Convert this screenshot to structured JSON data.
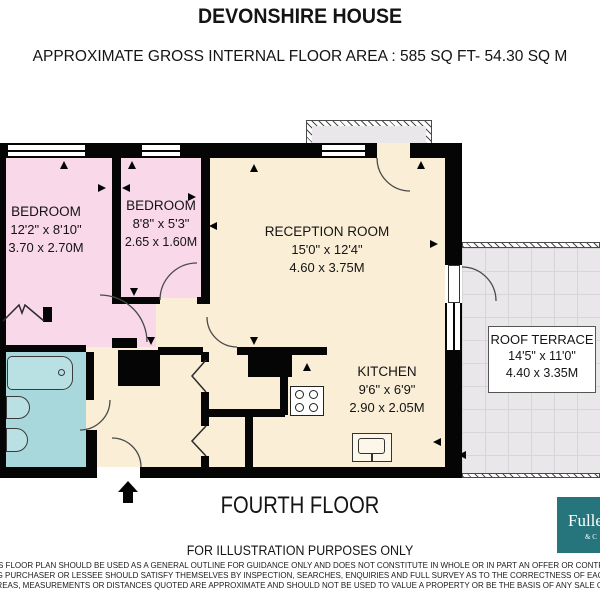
{
  "header": {
    "title": "DEVONSHIRE HOUSE",
    "subtitle": "APPROXIMATE GROSS INTERNAL FLOOR AREA :  585 SQ FT-  54.30 SQ M"
  },
  "rooms": {
    "bedroom1": {
      "name": "BEDROOM",
      "imperial": "12'2\" x 8'10\"",
      "metric": "3.70 x 2.70M"
    },
    "bedroom2": {
      "name": "BEDROOM",
      "imperial": "8'8\" x 5'3\"",
      "metric": "2.65 x 1.60M"
    },
    "reception": {
      "name": "RECEPTION ROOM",
      "imperial": "15'0\" x 12'4\"",
      "metric": "4.60 x 3.75M"
    },
    "kitchen": {
      "name": "KITCHEN",
      "imperial": "9'6\" x 6'9\"",
      "metric": "2.90 x 2.05M"
    },
    "roof_terrace": {
      "name": "ROOF TERRACE",
      "imperial": "14'5\" x 11'0\"",
      "metric": "4.40 x 3.35M"
    }
  },
  "footer": {
    "floor_label": "FOURTH FLOOR",
    "illustration_note": "FOR ILLUSTRATION PURPOSES ONLY",
    "disclaimer_lines": [
      "HIS FLOOR PLAN SHOULD BE USED AS A GENERAL OUTLINE FOR GUIDANCE ONLY AND DOES NOT CONSTITUTE IN WHOLE OR IN PART AN OFFER OR CONTRACT",
      "NG PURCHASER OR LESSEE SHOULD SATISFY THEMSELVES BY INSPECTION, SEARCHES, ENQUIRIES AND FULL SURVEY AS TO THE CORRECTNESS OF EACH",
      "AREAS, MEASUREMENTS OR DISTANCES QUOTED ARE APPROXIMATE AND SHOULD NOT BE USED TO VALUE A PROPERTY OR BE THE BASIS OF ANY SALE OR"
    ]
  },
  "logo": {
    "name_fragment": "Fulle",
    "sub_fragment": "& C"
  },
  "colors": {
    "bedroom_fill": "#f8d8e9",
    "living_fill": "#fbeed7",
    "bathroom_fill": "#a9d8dc",
    "terrace_fill": "#e9e7ea",
    "wall": "#050505",
    "logo_teal": "#26757d"
  }
}
